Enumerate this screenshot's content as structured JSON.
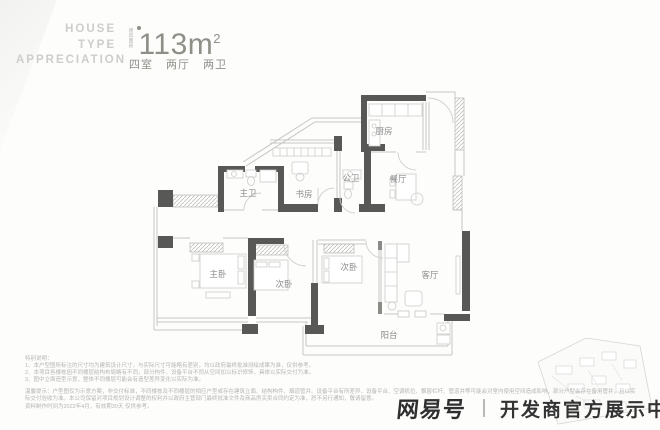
{
  "header": {
    "brand_lines": [
      "HOUSE",
      "TYPE",
      "APPRECIATION"
    ],
    "area_label_vertical": "建筑面积",
    "area_value": "113m",
    "area_sup": "2",
    "layout_summary": "四室 两厅 两卫",
    "accent_color": "#8f8f88"
  },
  "floorplan": {
    "wall_color": "#585856",
    "line_color": "#c6c6c3",
    "label_color": "#8c8c8c",
    "rooms": [
      {
        "name": "厨房"
      },
      {
        "name": "餐厅"
      },
      {
        "name": "公卫"
      },
      {
        "name": "书房"
      },
      {
        "name": "主卫"
      },
      {
        "name": "主卧"
      },
      {
        "name": "次卧"
      },
      {
        "name": "次卧"
      },
      {
        "name": "客厅"
      },
      {
        "name": "阳台"
      }
    ]
  },
  "notes": {
    "title": "特别说明：",
    "items": [
      "1、本户型图所标注的尺寸均为建筑设计尺寸，与实际尺寸可能略有差别，均以政府最终批准测绘成果为准，仅供参考。",
      "2、本项目各楼栋因不同楼层结构布局略有不同，部分构件、设备平台不同从空间加以标识修饰，具体以实际交付为准。",
      "3、图中立面造型示意，整体不同楼层可能会有造型差异变化以实际为准。"
    ],
    "tips": "温馨提示：户型图仅为示意方案，非交付标准，不同楼栋及不同楼层的相应户型或存在建筑立面、结构构件、烟道管井、设备平台有所差异，设备平台、空调机位、飘窗栏杆、管道井等可能会对室内使用空间造成影响，部分户型会存在备用管井，且以实际交付验收为准。本公司保留对项目规划设计调整的权利并以政府主管部门最终批准文件及商品房买卖合同约定为准，恕不另行通知，敬请留意。",
    "date": "资料制作时间为2022年4月，有效期30天 仅供参考。"
  },
  "watermark": {
    "brand": "网易号",
    "divider": "｜",
    "text": "开发商官方展示中心"
  }
}
